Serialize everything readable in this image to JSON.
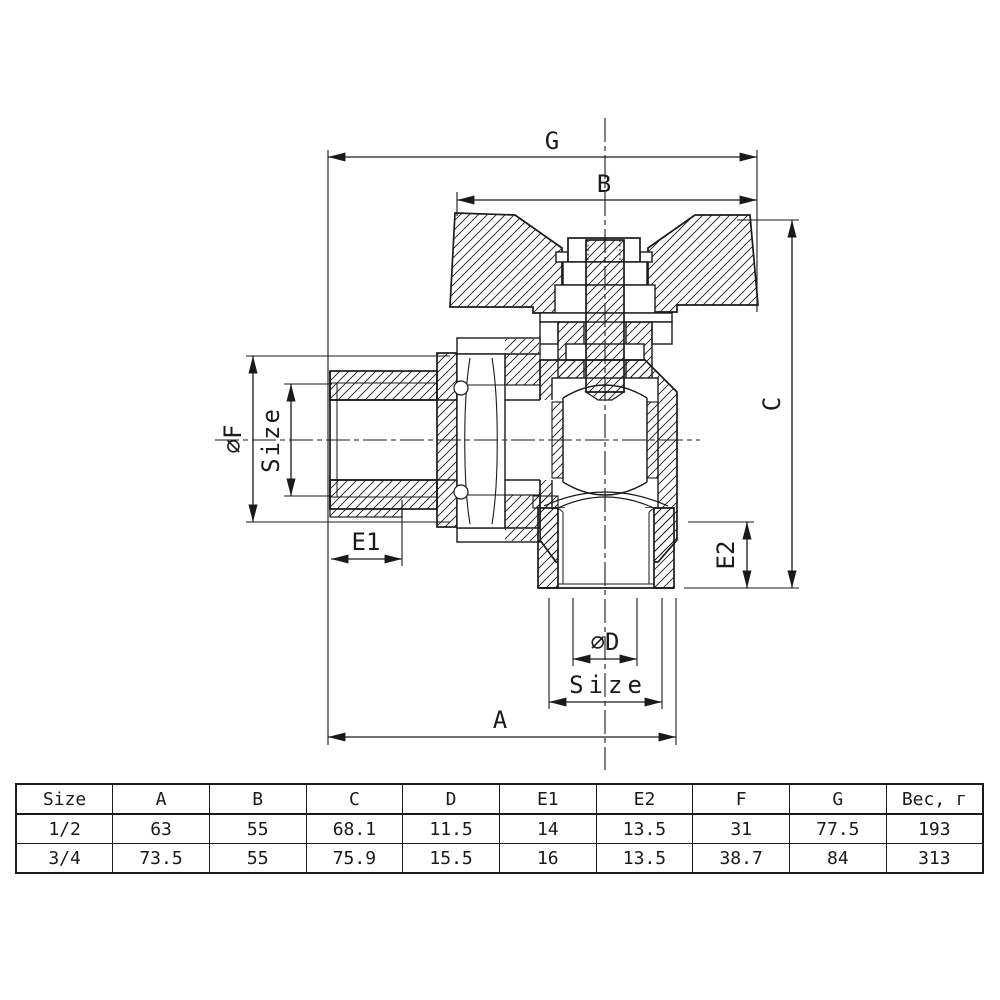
{
  "drawing": {
    "title": "angle ball valve cross-section",
    "labels": {
      "g": "G",
      "b": "B",
      "c": "C",
      "a": "A",
      "e1": "E1",
      "e2": "E2",
      "phi_f": "∅F",
      "phi_d": "∅D",
      "size_left": "Size",
      "size_bottom": "Size"
    }
  },
  "table": {
    "headers": [
      "Size",
      "A",
      "B",
      "C",
      "D",
      "E1",
      "E2",
      "F",
      "G",
      "Вес, г"
    ],
    "rows": [
      [
        "1/2",
        "63",
        "55",
        "68.1",
        "11.5",
        "14",
        "13.5",
        "31",
        "77.5",
        "193"
      ],
      [
        "3/4",
        "73.5",
        "55",
        "75.9",
        "15.5",
        "16",
        "13.5",
        "38.7",
        "84",
        "313"
      ]
    ]
  },
  "colors": {
    "line": "#1a1a1a",
    "background": "#ffffff"
  }
}
